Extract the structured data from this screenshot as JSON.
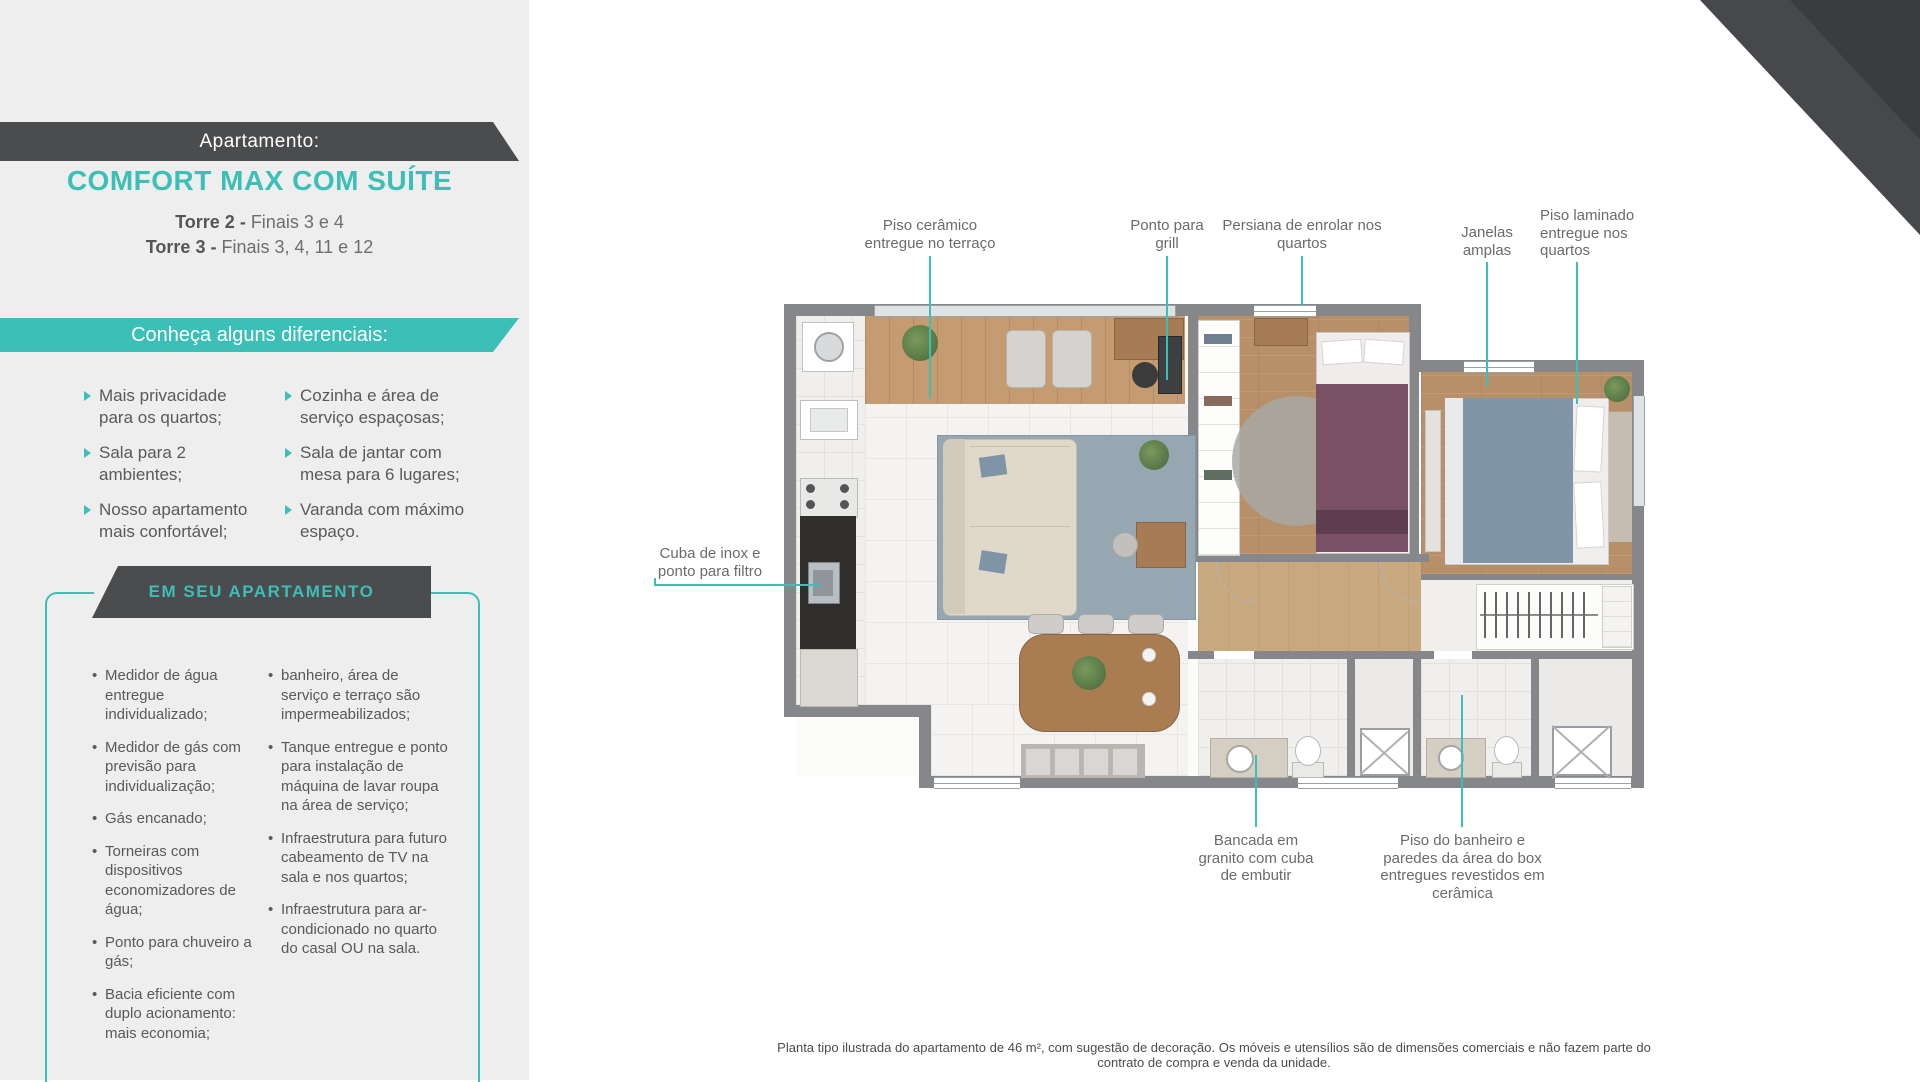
{
  "header": {
    "label": "Apartamento:",
    "name": "COMFORT MAX COM SUÍTE",
    "towers": [
      {
        "prefix": "Torre 2 - ",
        "value": "Finais 3 e 4"
      },
      {
        "prefix": "Torre 3 - ",
        "value": "Finais 3, 4, 11 e 12"
      }
    ]
  },
  "diferenciais": {
    "title": "Conheça alguns diferenciais:",
    "col1": [
      "Mais privacidade para os quartos;",
      "Sala para 2 ambientes;",
      "Nosso apartamento mais confortável;"
    ],
    "col2": [
      "Cozinha e área de serviço espaçosas;",
      "Sala de jantar com mesa para 6 lugares;",
      "Varanda com máximo espaço."
    ]
  },
  "em_seu_apartamento": {
    "title": "EM SEU APARTAMENTO",
    "col1": [
      "Medidor de água entregue individualizado;",
      "Medidor de gás com previsão para individualização;",
      "Gás encanado;",
      "Torneiras com dispositivos economizadores de água;",
      "Ponto para chuveiro a gás;",
      "Bacia eficiente com duplo acionamento: mais economia;"
    ],
    "col2": [
      "banheiro, área de serviço e terraço são impermeabilizados;",
      "Tanque entregue e ponto para instalação de máquina de lavar roupa na área de serviço;",
      "Infraestrutura para futuro cabeamento de TV na sala e nos quartos;",
      "Infraestrutura para ar-condicionado no quarto do casal OU na sala."
    ]
  },
  "plan": {
    "callouts": {
      "piso_ceramico": "Piso cerâmico entregue no terraço",
      "ponto_grill": "Ponto para grill",
      "persiana": "Persiana de enrolar nos quartos",
      "janelas": "Janelas amplas",
      "piso_laminado": "Piso laminado entregue nos quartos",
      "cuba_inox": "Cuba de inox e ponto para filtro",
      "bancada": "Bancada em granito com cuba de embutir",
      "piso_banheiro": "Piso do banheiro e paredes da área do box entregues revestidos em cerâmica"
    },
    "disclaimer": "Planta tipo ilustrada do apartamento de 46 m², com sugestão de decoração. Os móveis e utensílios são de dimensões comerciais e não fazem parte do contrato de compra e venda da unidade."
  },
  "colors": {
    "teal": "#3bbfb6",
    "dark": "#4a4c4e",
    "text": "#58595b"
  }
}
